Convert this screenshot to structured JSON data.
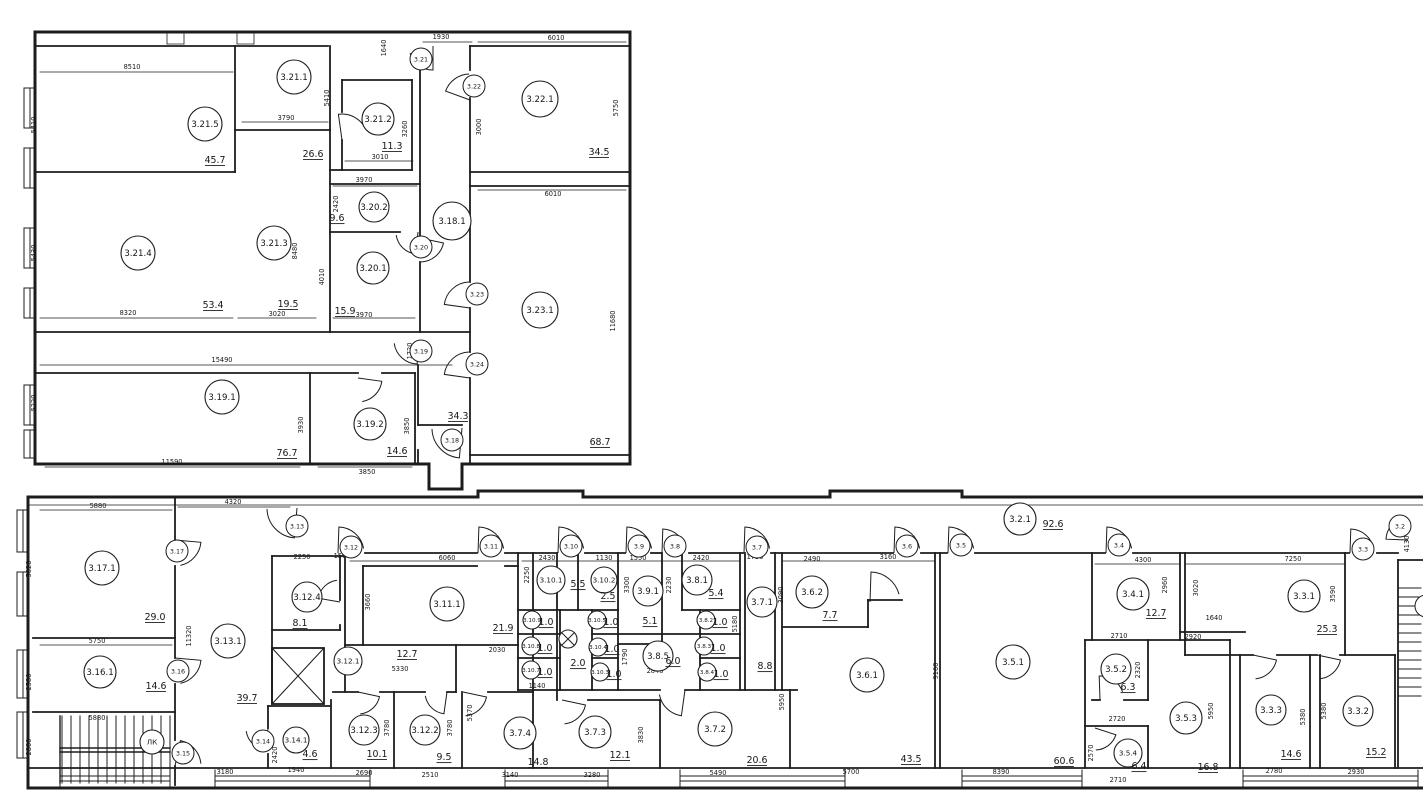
{
  "drawing": {
    "type": "architectural-floor-plan",
    "floor": "3"
  },
  "colors": {
    "line": "#1c1c1c",
    "bg": "#ffffff"
  },
  "symbols": {
    "stair_label": "ЛК",
    "crossed_circle_area": "2.0"
  },
  "rooms": [
    {
      "l": "3.21.5",
      "a": "45.7",
      "x": 205,
      "y": 124,
      "r": 17,
      "ax": 215,
      "ay": 163
    },
    {
      "l": "3.21.1",
      "a": "26.6",
      "x": 294,
      "y": 77,
      "r": 17,
      "ax": 313,
      "ay": 157
    },
    {
      "l": "3.21.2",
      "a": "11.3",
      "x": 378,
      "y": 119,
      "r": 16,
      "ax": 392,
      "ay": 149
    },
    {
      "l": "3.20.2",
      "a": "9.6",
      "x": 374,
      "y": 207,
      "r": 15,
      "ax": 337,
      "ay": 221
    },
    {
      "l": "3.20.1",
      "a": "15.9",
      "x": 373,
      "y": 268,
      "r": 16,
      "ax": 345,
      "ay": 314
    },
    {
      "l": "3.21.3",
      "a": "19.5",
      "x": 274,
      "y": 243,
      "r": 17,
      "ax": 288,
      "ay": 307
    },
    {
      "l": "3.21.4",
      "a": "53.4",
      "x": 138,
      "y": 253,
      "r": 17,
      "ax": 213,
      "ay": 308
    },
    {
      "l": "3.22.1",
      "a": "34.5",
      "x": 540,
      "y": 99,
      "r": 18,
      "ax": 599,
      "ay": 155
    },
    {
      "l": "3.23.1",
      "a": "68.7",
      "x": 540,
      "y": 310,
      "r": 18,
      "ax": 600,
      "ay": 445
    },
    {
      "l": "3.18.1",
      "a": "34.3",
      "x": 452,
      "y": 221,
      "r": 19,
      "ax": 458,
      "ay": 419
    },
    {
      "l": "3.19.1",
      "a": "76.7",
      "x": 222,
      "y": 397,
      "r": 17,
      "ax": 287,
      "ay": 456
    },
    {
      "l": "3.19.2",
      "a": "14.6",
      "x": 370,
      "y": 424,
      "r": 16,
      "ax": 397,
      "ay": 454
    },
    {
      "l": "3.17.1",
      "a": "29.0",
      "x": 102,
      "y": 568,
      "r": 17,
      "ax": 155,
      "ay": 620
    },
    {
      "l": "3.16.1",
      "a": "14.6",
      "x": 100,
      "y": 672,
      "r": 16,
      "ax": 156,
      "ay": 689
    },
    {
      "l": "ЛК",
      "a": null,
      "x": 152,
      "y": 742,
      "r": 12,
      "ax": 0,
      "ay": 0
    },
    {
      "l": "3.13.1",
      "a": "39.7",
      "x": 228,
      "y": 641,
      "r": 17,
      "ax": 247,
      "ay": 701
    },
    {
      "l": "3.14.1",
      "a": "4.6",
      "x": 296,
      "y": 740,
      "r": 13,
      "ax": 310,
      "ay": 757
    },
    {
      "l": "3.12.4",
      "a": "8.1",
      "x": 307,
      "y": 597,
      "r": 15,
      "ax": 300,
      "ay": 626
    },
    {
      "l": "3.12.1",
      "a": "12.7",
      "x": 348,
      "y": 661,
      "r": 14,
      "ax": 407,
      "ay": 657
    },
    {
      "l": "3.12.3",
      "a": "10.1",
      "x": 364,
      "y": 730,
      "r": 15,
      "ax": 377,
      "ay": 757
    },
    {
      "l": "3.12.2",
      "a": "9.5",
      "x": 425,
      "y": 730,
      "r": 15,
      "ax": 444,
      "ay": 760
    },
    {
      "l": "3.11.1",
      "a": "21.9",
      "x": 447,
      "y": 604,
      "r": 17,
      "ax": 503,
      "ay": 631
    },
    {
      "l": "3.10.1",
      "a": "5.5",
      "x": 551,
      "y": 580,
      "r": 14,
      "ax": 578,
      "ay": 587
    },
    {
      "l": "3.10.2",
      "a": "2.5",
      "x": 604,
      "y": 580,
      "r": 13,
      "ax": 608,
      "ay": 599
    },
    {
      "l": "3.9.1",
      "a": "5.1",
      "x": 648,
      "y": 591,
      "r": 15,
      "ax": 650,
      "ay": 624
    },
    {
      "l": "3.8.1",
      "a": "5.4",
      "x": 697,
      "y": 580,
      "r": 15,
      "ax": 716,
      "ay": 596
    },
    {
      "l": "3.10.9",
      "a": "1.0",
      "x": 532,
      "y": 620,
      "r": 9,
      "ax": 546,
      "ay": 625
    },
    {
      "l": "3.10.8",
      "a": "1.0",
      "x": 531,
      "y": 646,
      "r": 9,
      "ax": 545,
      "ay": 651
    },
    {
      "l": "3.10.7",
      "a": "1.0",
      "x": 531,
      "y": 670,
      "r": 9,
      "ax": 545,
      "ay": 675
    },
    {
      "l": "3.10.5",
      "a": "1.0",
      "x": 597,
      "y": 620,
      "r": 9,
      "ax": 611,
      "ay": 625
    },
    {
      "l": "3.10.4",
      "a": "1.0",
      "x": 598,
      "y": 647,
      "r": 9,
      "ax": 612,
      "ay": 652
    },
    {
      "l": "3.10.3",
      "a": "1.0",
      "x": 600,
      "y": 672,
      "r": 9,
      "ax": 614,
      "ay": 677
    },
    {
      "l": "3.8.2",
      "a": "1.0",
      "x": 706,
      "y": 620,
      "r": 9,
      "ax": 720,
      "ay": 625
    },
    {
      "l": "3.8.3",
      "a": "1.0",
      "x": 704,
      "y": 646,
      "r": 9,
      "ax": 718,
      "ay": 651
    },
    {
      "l": "3.8.4",
      "a": "1.0",
      "x": 707,
      "y": 672,
      "r": 9,
      "ax": 721,
      "ay": 677
    },
    {
      "l": "3.8.5",
      "a": "6.0",
      "x": 658,
      "y": 656,
      "r": 15,
      "ax": 673,
      "ay": 664
    },
    {
      "l": "3.7.1",
      "a": "8.8",
      "x": 762,
      "y": 602,
      "r": 15,
      "ax": 765,
      "ay": 669
    },
    {
      "l": "3.6.2",
      "a": "7.7",
      "x": 812,
      "y": 592,
      "r": 16,
      "ax": 830,
      "ay": 618
    },
    {
      "l": "3.6.1",
      "a": "43.5",
      "x": 867,
      "y": 675,
      "r": 17,
      "ax": 911,
      "ay": 762
    },
    {
      "l": "3.5.1",
      "a": "60.6",
      "x": 1013,
      "y": 662,
      "r": 17,
      "ax": 1064,
      "ay": 764
    },
    {
      "l": "3.2.1",
      "a": "92.6",
      "x": 1020,
      "y": 519,
      "r": 16,
      "ax": 1053,
      "ay": 527
    },
    {
      "l": "3.4.1",
      "a": "12.7",
      "x": 1133,
      "y": 594,
      "r": 16,
      "ax": 1156,
      "ay": 616
    },
    {
      "l": "3.3.1",
      "a": "25.3",
      "x": 1304,
      "y": 596,
      "r": 16,
      "ax": 1327,
      "ay": 632
    },
    {
      "l": "3.5.2",
      "a": "6.3",
      "x": 1116,
      "y": 669,
      "r": 15,
      "ax": 1128,
      "ay": 690
    },
    {
      "l": "3.5.3",
      "a": "16.8",
      "x": 1186,
      "y": 718,
      "r": 16,
      "ax": 1208,
      "ay": 770
    },
    {
      "l": "3.5.4",
      "a": "6.4",
      "x": 1128,
      "y": 753,
      "r": 14,
      "ax": 1139,
      "ay": 769
    },
    {
      "l": "3.3.3",
      "a": "14.6",
      "x": 1271,
      "y": 710,
      "r": 15,
      "ax": 1291,
      "ay": 757
    },
    {
      "l": "3.3.2",
      "a": "15.2",
      "x": 1358,
      "y": 711,
      "r": 15,
      "ax": 1376,
      "ay": 755
    },
    {
      "l": "3.7.4",
      "a": "14.8",
      "x": 520,
      "y": 733,
      "r": 16,
      "ax": 538,
      "ay": 765
    },
    {
      "l": "3.7.3",
      "a": "12.1",
      "x": 595,
      "y": 732,
      "r": 16,
      "ax": 620,
      "ay": 758
    },
    {
      "l": "3.7.2",
      "a": "20.6",
      "x": 715,
      "y": 729,
      "r": 17,
      "ax": 757,
      "ay": 763
    }
  ],
  "door_labels": [
    {
      "l": "3.21",
      "x": 421,
      "y": 59
    },
    {
      "l": "3.22",
      "x": 474,
      "y": 86
    },
    {
      "l": "3.20",
      "x": 421,
      "y": 247
    },
    {
      "l": "3.23",
      "x": 477,
      "y": 294
    },
    {
      "l": "3.24",
      "x": 477,
      "y": 364
    },
    {
      "l": "3.19",
      "x": 421,
      "y": 351
    },
    {
      "l": "3.18",
      "x": 452,
      "y": 440
    },
    {
      "l": "3.17",
      "x": 177,
      "y": 551
    },
    {
      "l": "3.16",
      "x": 178,
      "y": 671
    },
    {
      "l": "3.15",
      "x": 183,
      "y": 753
    },
    {
      "l": "3.14",
      "x": 263,
      "y": 741
    },
    {
      "l": "3.13",
      "x": 297,
      "y": 526
    },
    {
      "l": "3.12",
      "x": 351,
      "y": 547
    },
    {
      "l": "3.11",
      "x": 491,
      "y": 546
    },
    {
      "l": "3.10",
      "x": 571,
      "y": 546
    },
    {
      "l": "3.9",
      "x": 639,
      "y": 546
    },
    {
      "l": "3.8",
      "x": 675,
      "y": 546
    },
    {
      "l": "3.7",
      "x": 757,
      "y": 547
    },
    {
      "l": "3.6",
      "x": 907,
      "y": 546
    },
    {
      "l": "3.5",
      "x": 961,
      "y": 545
    },
    {
      "l": "3.4",
      "x": 1119,
      "y": 545
    },
    {
      "l": "3.3",
      "x": 1363,
      "y": 549
    },
    {
      "l": "3.2",
      "x": 1400,
      "y": 526
    },
    {
      "l": "",
      "x": 1426,
      "y": 606
    }
  ],
  "crossed_circle": {
    "x": 568,
    "y": 639,
    "r": 9,
    "ax": 578,
    "ay": 666
  },
  "dimensions": [
    {
      "t": "8510",
      "x": 132,
      "y": 69
    },
    {
      "t": "5410",
      "x": 36,
      "y": 125,
      "v": 1
    },
    {
      "t": "5410",
      "x": 329,
      "y": 98,
      "v": 1
    },
    {
      "t": "1640",
      "x": 386,
      "y": 48,
      "v": 1
    },
    {
      "t": "3790",
      "x": 286,
      "y": 120
    },
    {
      "t": "1930",
      "x": 441,
      "y": 39
    },
    {
      "t": "6010",
      "x": 556,
      "y": 40
    },
    {
      "t": "5750",
      "x": 618,
      "y": 108,
      "v": 1
    },
    {
      "t": "3000",
      "x": 481,
      "y": 127,
      "v": 1
    },
    {
      "t": "3010",
      "x": 380,
      "y": 159
    },
    {
      "t": "3260",
      "x": 407,
      "y": 129,
      "v": 1
    },
    {
      "t": "3970",
      "x": 364,
      "y": 182
    },
    {
      "t": "2420",
      "x": 338,
      "y": 204,
      "v": 1
    },
    {
      "t": "6010",
      "x": 553,
      "y": 196
    },
    {
      "t": "8320",
      "x": 128,
      "y": 315
    },
    {
      "t": "3020",
      "x": 277,
      "y": 316
    },
    {
      "t": "3970",
      "x": 364,
      "y": 317
    },
    {
      "t": "4010",
      "x": 324,
      "y": 277,
      "v": 1
    },
    {
      "t": "8480",
      "x": 297,
      "y": 251,
      "v": 1
    },
    {
      "t": "5430",
      "x": 36,
      "y": 253,
      "v": 1
    },
    {
      "t": "15490",
      "x": 222,
      "y": 362
    },
    {
      "t": "1720",
      "x": 412,
      "y": 351,
      "v": 1
    },
    {
      "t": "5220",
      "x": 36,
      "y": 403,
      "v": 1
    },
    {
      "t": "11590",
      "x": 172,
      "y": 464
    },
    {
      "t": "3930",
      "x": 303,
      "y": 425,
      "v": 1
    },
    {
      "t": "3850",
      "x": 409,
      "y": 426,
      "v": 1
    },
    {
      "t": "3850",
      "x": 367,
      "y": 474
    },
    {
      "t": "11680",
      "x": 615,
      "y": 321,
      "v": 1
    },
    {
      "t": "5880",
      "x": 98,
      "y": 508
    },
    {
      "t": "4320",
      "x": 233,
      "y": 504
    },
    {
      "t": "5020",
      "x": 31,
      "y": 569,
      "v": 1
    },
    {
      "t": "5750",
      "x": 97,
      "y": 643
    },
    {
      "t": "2580",
      "x": 31,
      "y": 682,
      "v": 1
    },
    {
      "t": "2800",
      "x": 31,
      "y": 747,
      "v": 1
    },
    {
      "t": "5880",
      "x": 97,
      "y": 720
    },
    {
      "t": "11320",
      "x": 191,
      "y": 636,
      "v": 1
    },
    {
      "t": "2250",
      "x": 302,
      "y": 559
    },
    {
      "t": "1500",
      "x": 342,
      "y": 558
    },
    {
      "t": "6060",
      "x": 447,
      "y": 560
    },
    {
      "t": "3660",
      "x": 370,
      "y": 602,
      "v": 1
    },
    {
      "t": "2030",
      "x": 497,
      "y": 652
    },
    {
      "t": "5330",
      "x": 400,
      "y": 671
    },
    {
      "t": "2690",
      "x": 364,
      "y": 775
    },
    {
      "t": "2510",
      "x": 430,
      "y": 777
    },
    {
      "t": "3780",
      "x": 389,
      "y": 728,
      "v": 1
    },
    {
      "t": "3780",
      "x": 452,
      "y": 728,
      "v": 1
    },
    {
      "t": "3140",
      "x": 510,
      "y": 777
    },
    {
      "t": "5370",
      "x": 472,
      "y": 713,
      "v": 1
    },
    {
      "t": "3830",
      "x": 527,
      "y": 732,
      "v": 1
    },
    {
      "t": "3830",
      "x": 643,
      "y": 735,
      "v": 1
    },
    {
      "t": "3280",
      "x": 592,
      "y": 777
    },
    {
      "t": "5490",
      "x": 718,
      "y": 775
    },
    {
      "t": "5950",
      "x": 784,
      "y": 702,
      "v": 1
    },
    {
      "t": "2430",
      "x": 547,
      "y": 560
    },
    {
      "t": "2250",
      "x": 529,
      "y": 575,
      "v": 1
    },
    {
      "t": "1130",
      "x": 604,
      "y": 560
    },
    {
      "t": "1550",
      "x": 638,
      "y": 560
    },
    {
      "t": "3300",
      "x": 629,
      "y": 585,
      "v": 1
    },
    {
      "t": "2420",
      "x": 701,
      "y": 560
    },
    {
      "t": "2230",
      "x": 671,
      "y": 585,
      "v": 1
    },
    {
      "t": "2840",
      "x": 655,
      "y": 673
    },
    {
      "t": "1790",
      "x": 627,
      "y": 657,
      "v": 1
    },
    {
      "t": "1140",
      "x": 537,
      "y": 688
    },
    {
      "t": "1730",
      "x": 755,
      "y": 559
    },
    {
      "t": "5180",
      "x": 737,
      "y": 624,
      "v": 1
    },
    {
      "t": "2490",
      "x": 812,
      "y": 561
    },
    {
      "t": "3090",
      "x": 783,
      "y": 595,
      "v": 1
    },
    {
      "t": "3160",
      "x": 888,
      "y": 559
    },
    {
      "t": "9160",
      "x": 938,
      "y": 671,
      "v": 1
    },
    {
      "t": "5700",
      "x": 851,
      "y": 774
    },
    {
      "t": "8390",
      "x": 1001,
      "y": 774
    },
    {
      "t": "4300",
      "x": 1143,
      "y": 562
    },
    {
      "t": "2960",
      "x": 1167,
      "y": 585,
      "v": 1
    },
    {
      "t": "1640",
      "x": 1214,
      "y": 620
    },
    {
      "t": "7250",
      "x": 1293,
      "y": 561
    },
    {
      "t": "3020",
      "x": 1198,
      "y": 588,
      "v": 1
    },
    {
      "t": "3590",
      "x": 1335,
      "y": 594,
      "v": 1
    },
    {
      "t": "2710",
      "x": 1119,
      "y": 638
    },
    {
      "t": "2920",
      "x": 1193,
      "y": 639
    },
    {
      "t": "2320",
      "x": 1140,
      "y": 670,
      "v": 1
    },
    {
      "t": "5950",
      "x": 1213,
      "y": 711,
      "v": 1
    },
    {
      "t": "2720",
      "x": 1117,
      "y": 721
    },
    {
      "t": "2570",
      "x": 1093,
      "y": 753,
      "v": 1
    },
    {
      "t": "2710",
      "x": 1118,
      "y": 782
    },
    {
      "t": "2780",
      "x": 1274,
      "y": 773
    },
    {
      "t": "2930",
      "x": 1356,
      "y": 774
    },
    {
      "t": "5380",
      "x": 1305,
      "y": 717,
      "v": 1
    },
    {
      "t": "5380",
      "x": 1326,
      "y": 711,
      "v": 1
    },
    {
      "t": "4130",
      "x": 1409,
      "y": 544,
      "v": 1
    },
    {
      "t": "3180",
      "x": 225,
      "y": 774
    },
    {
      "t": "1940",
      "x": 296,
      "y": 772
    },
    {
      "t": "2420",
      "x": 277,
      "y": 755,
      "v": 1
    }
  ]
}
